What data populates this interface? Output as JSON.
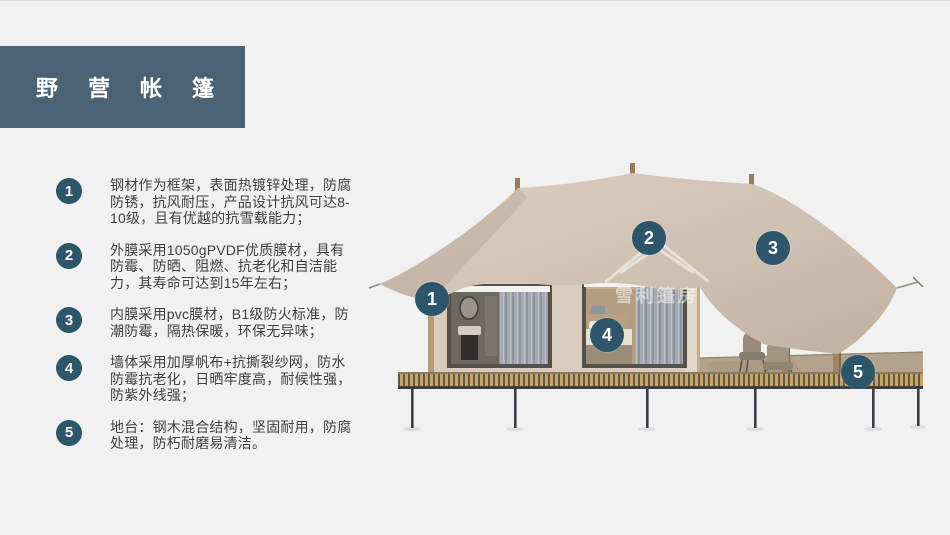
{
  "slide": {
    "title": "野营帐篷",
    "colors": {
      "background": "#f1f1f2",
      "title_block": "#4b6275",
      "badge": "#2d566b",
      "body_text": "#3f3f3f",
      "canopy": "#cfc1b2",
      "deck_stripe": "#c9a562"
    }
  },
  "features": [
    {
      "num": "1",
      "text": "钢材作为框架，表面热镀锌处理，防腐防锈，抗风耐压，产品设计抗风可达8-10级，且有优越的抗雪载能力；"
    },
    {
      "num": "2",
      "text": "外膜采用1050gPVDF优质膜材，具有防霉、防晒、阻燃、抗老化和自洁能力，其寿命可达到15年左右；"
    },
    {
      "num": "3",
      "text": "内膜采用pvc膜材，B1级防火标准，防潮防霉，隔热保暖，环保无异味；"
    },
    {
      "num": "4",
      "text": "墙体采用加厚帆布+抗撕裂纱网，防水防霉抗老化，日晒牢度高，耐候性强，防紫外线强；"
    },
    {
      "num": "5",
      "text": "地台：钢木混合结构，坚固耐用，防腐处理，防朽耐磨易清洁。"
    }
  ],
  "image_markers": [
    {
      "label": "1"
    },
    {
      "label": "2"
    },
    {
      "label": "3"
    },
    {
      "label": "4"
    },
    {
      "label": "5"
    }
  ],
  "watermark": {
    "text": "雪利篷房"
  }
}
